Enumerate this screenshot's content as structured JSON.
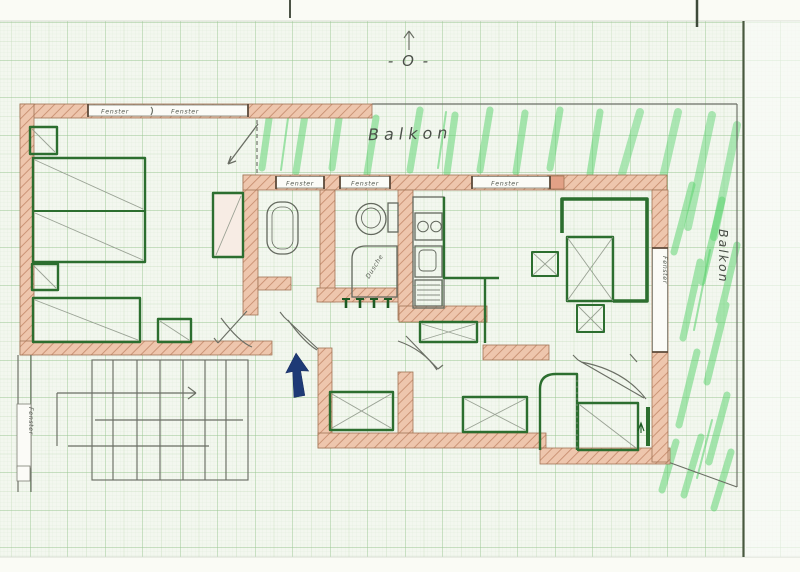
{
  "scene": {
    "description": "Hand-drawn apartment floor plan on green millimeter graph paper",
    "compass_label": "- O -",
    "balcony_top_label": "Balkon",
    "balcony_right_label": "Balkon",
    "shower_label": "Dusche",
    "window_labels": {
      "top_wall_left": "Fenster",
      "top_wall_right": "Fenster",
      "mid_wall_1": "Fenster",
      "mid_wall_2": "Fenster",
      "mid_wall_3": "Fenster",
      "right_wall": "Fenster",
      "stairwell": "Fenster"
    },
    "colors": {
      "paper": "#f3f7ef",
      "grid_minor": "#dcead6",
      "grid_medium": "#bcd8b2",
      "grid_major": "#98c690",
      "wall_fill": "#eec6ad",
      "wall_hatch": "#c88f71",
      "ink_green": "#2c6e2f",
      "balcony_green": "#55d16a",
      "pencil": "#6a6e64",
      "entrance_arrow_blue": "#1e3a76",
      "sheet_edge": "#49593f"
    }
  }
}
